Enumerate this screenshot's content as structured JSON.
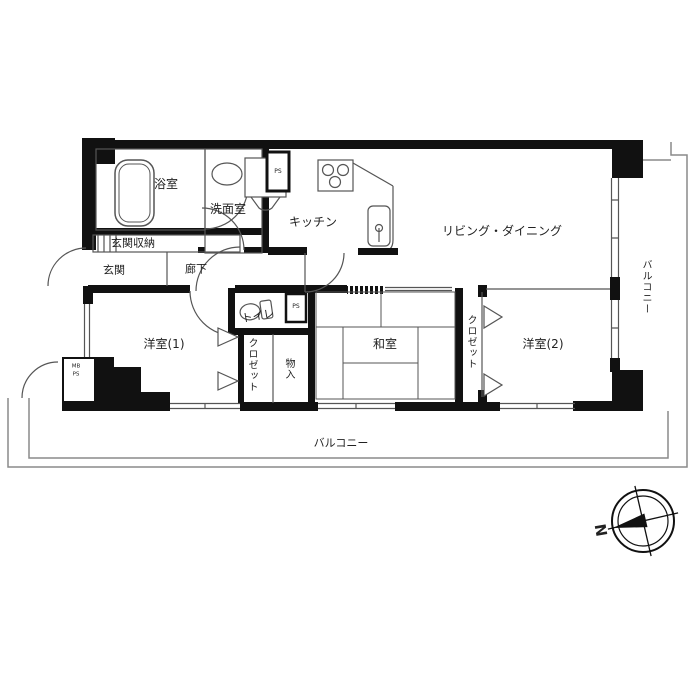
{
  "title": "apartment-floor-plan",
  "colors": {
    "wall": "#111111",
    "thin_line": "#555555",
    "railing": "#8a8a8a",
    "text": "#222222",
    "background": "#ffffff"
  },
  "rooms": {
    "bath": "浴室",
    "washroom": "洗面室",
    "kitchen": "キッチン",
    "living_dining": "リビング・ダイニング",
    "entrance_storage": "玄関収納",
    "entrance": "玄関",
    "hallway": "廊下",
    "toilet": "トイレ",
    "western1": "洋室(1)",
    "closet1": "クロゼット",
    "storage_in": "物入",
    "japanese": "和室",
    "closet2": "クロゼット",
    "western2": "洋室(2)"
  },
  "balcony": {
    "right": "バルコニー",
    "bottom": "バルコニー"
  },
  "utility": {
    "ps_top": "PS",
    "ps_toilet": "PS",
    "mb": "MB",
    "ps": "PS"
  },
  "compass": {
    "north": "N"
  },
  "icons": [
    "bathtub-icon",
    "washbasin-icon",
    "washer-icon",
    "stove-icon",
    "kitchen-sink-icon",
    "toilet-icon",
    "closet-door-icon",
    "door-arc-icon",
    "compass-icon"
  ]
}
